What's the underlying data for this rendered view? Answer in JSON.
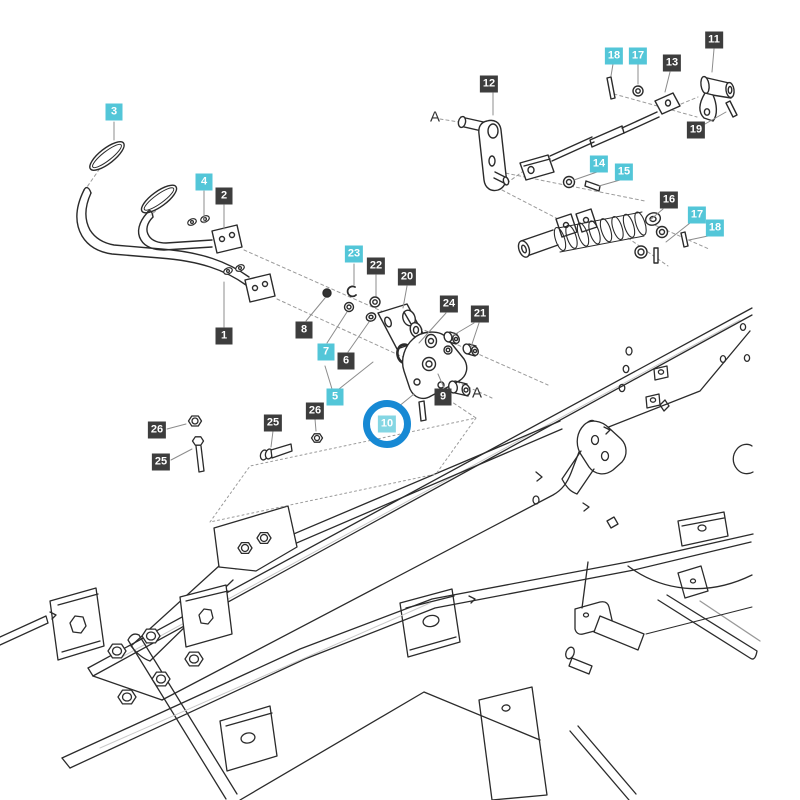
{
  "diagram": {
    "type": "exploded-parts-diagram",
    "subject": "pedal and linkage assembly over chassis frame",
    "colors": {
      "label_dark_bg": "#3d3d3d",
      "label_cyan_bg": "#53c6d8",
      "label_highlight_bg": "#84d6e3",
      "highlight_ring": "#1789d4",
      "label_text": "#ffffff",
      "line_art": "#2b2b2b"
    },
    "highlighted_part": "10",
    "labels": [
      {
        "text": "3",
        "variant": "cyan",
        "x": 114,
        "y": 112
      },
      {
        "text": "4",
        "variant": "cyan",
        "x": 204,
        "y": 182
      },
      {
        "text": "2",
        "variant": "dark",
        "x": 224,
        "y": 196
      },
      {
        "text": "1",
        "variant": "dark",
        "x": 224,
        "y": 336
      },
      {
        "text": "23",
        "variant": "cyan",
        "x": 354,
        "y": 254
      },
      {
        "text": "22",
        "variant": "dark",
        "x": 376,
        "y": 266
      },
      {
        "text": "20",
        "variant": "dark",
        "x": 407,
        "y": 277
      },
      {
        "text": "24",
        "variant": "dark",
        "x": 449,
        "y": 304
      },
      {
        "text": "21",
        "variant": "dark",
        "x": 480,
        "y": 314
      },
      {
        "text": "8",
        "variant": "dark",
        "x": 304,
        "y": 330
      },
      {
        "text": "7",
        "variant": "cyan",
        "x": 326,
        "y": 352
      },
      {
        "text": "6",
        "variant": "dark",
        "x": 346,
        "y": 361
      },
      {
        "text": "5",
        "variant": "cyan",
        "x": 335,
        "y": 397
      },
      {
        "text": "9",
        "variant": "dark",
        "x": 443,
        "y": 397
      },
      {
        "text": "10",
        "variant": "highlight",
        "x": 387,
        "y": 424
      },
      {
        "text": "26",
        "variant": "dark",
        "x": 157,
        "y": 430
      },
      {
        "text": "25",
        "variant": "dark",
        "x": 161,
        "y": 462
      },
      {
        "text": "25",
        "variant": "dark",
        "x": 273,
        "y": 423
      },
      {
        "text": "26",
        "variant": "dark",
        "x": 315,
        "y": 411
      },
      {
        "text": "12",
        "variant": "dark",
        "x": 489,
        "y": 84
      },
      {
        "text": "18",
        "variant": "cyan",
        "x": 614,
        "y": 56
      },
      {
        "text": "17",
        "variant": "cyan",
        "x": 638,
        "y": 56
      },
      {
        "text": "13",
        "variant": "dark",
        "x": 672,
        "y": 63
      },
      {
        "text": "11",
        "variant": "dark",
        "x": 714,
        "y": 40
      },
      {
        "text": "19",
        "variant": "dark",
        "x": 696,
        "y": 130
      },
      {
        "text": "14",
        "variant": "cyan",
        "x": 599,
        "y": 164
      },
      {
        "text": "15",
        "variant": "cyan",
        "x": 624,
        "y": 172
      },
      {
        "text": "16",
        "variant": "dark",
        "x": 669,
        "y": 200
      },
      {
        "text": "17",
        "variant": "cyan",
        "x": 697,
        "y": 215
      },
      {
        "text": "18",
        "variant": "cyan",
        "x": 715,
        "y": 228
      }
    ],
    "markers": [
      {
        "text": "A",
        "x": 435,
        "y": 117
      },
      {
        "text": "A",
        "x": 477,
        "y": 393
      }
    ]
  }
}
